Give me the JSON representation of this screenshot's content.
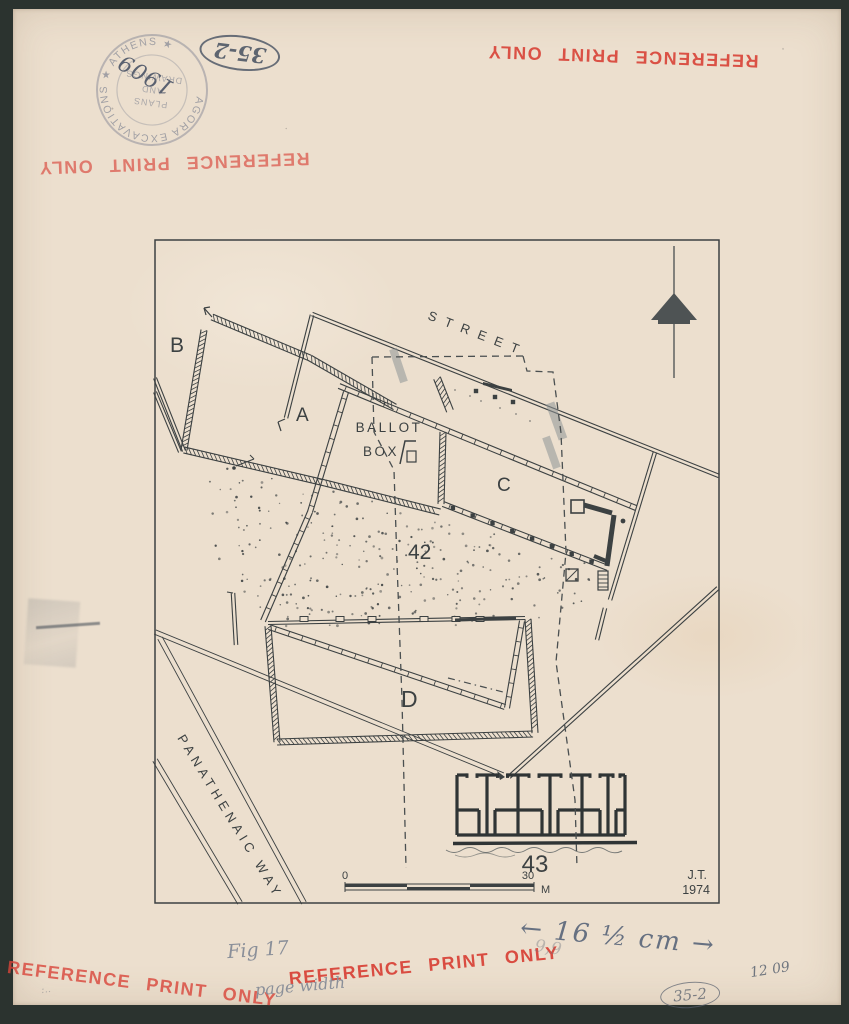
{
  "colors": {
    "paper": "#ecdfce",
    "ink": "#3c4142",
    "stamp_red": "#d9453a",
    "pencil": "#70767f",
    "surround": "#2b332f"
  },
  "icons": {
    "north_arrow": "north-arrow-icon"
  },
  "stamps": {
    "reference": "REFERENCE PRINT ONLY",
    "ring_text": "AGORA EXCAVATIONS ★ ATHENS ★",
    "ring_line1": "PLANS",
    "ring_line2": "AND",
    "ring_line3": "DRAWINGS",
    "ring_number": "1909",
    "oval_top": "35-2",
    "oval_bottom": "35-2"
  },
  "annotations": {
    "figure": "Fig 17",
    "page_width": "page width",
    "width_note": "← 16 ½ cm →",
    "faint_note": "9,9",
    "date_code": "12 09"
  },
  "plan": {
    "labels": {
      "building_b": "B",
      "building_a": "A",
      "building_c": "C",
      "area_42": "42",
      "building_d": "D",
      "building_43": "43",
      "street": "STREET",
      "ballot_line1": "BALLOT",
      "ballot_line2": "BOX",
      "panathenaic_way": "PANATHENAIC WAY"
    },
    "scale": {
      "zero": "0",
      "thirty": "30",
      "unit": "M"
    },
    "credit": {
      "initials": "J.T.",
      "year": "1974"
    }
  }
}
